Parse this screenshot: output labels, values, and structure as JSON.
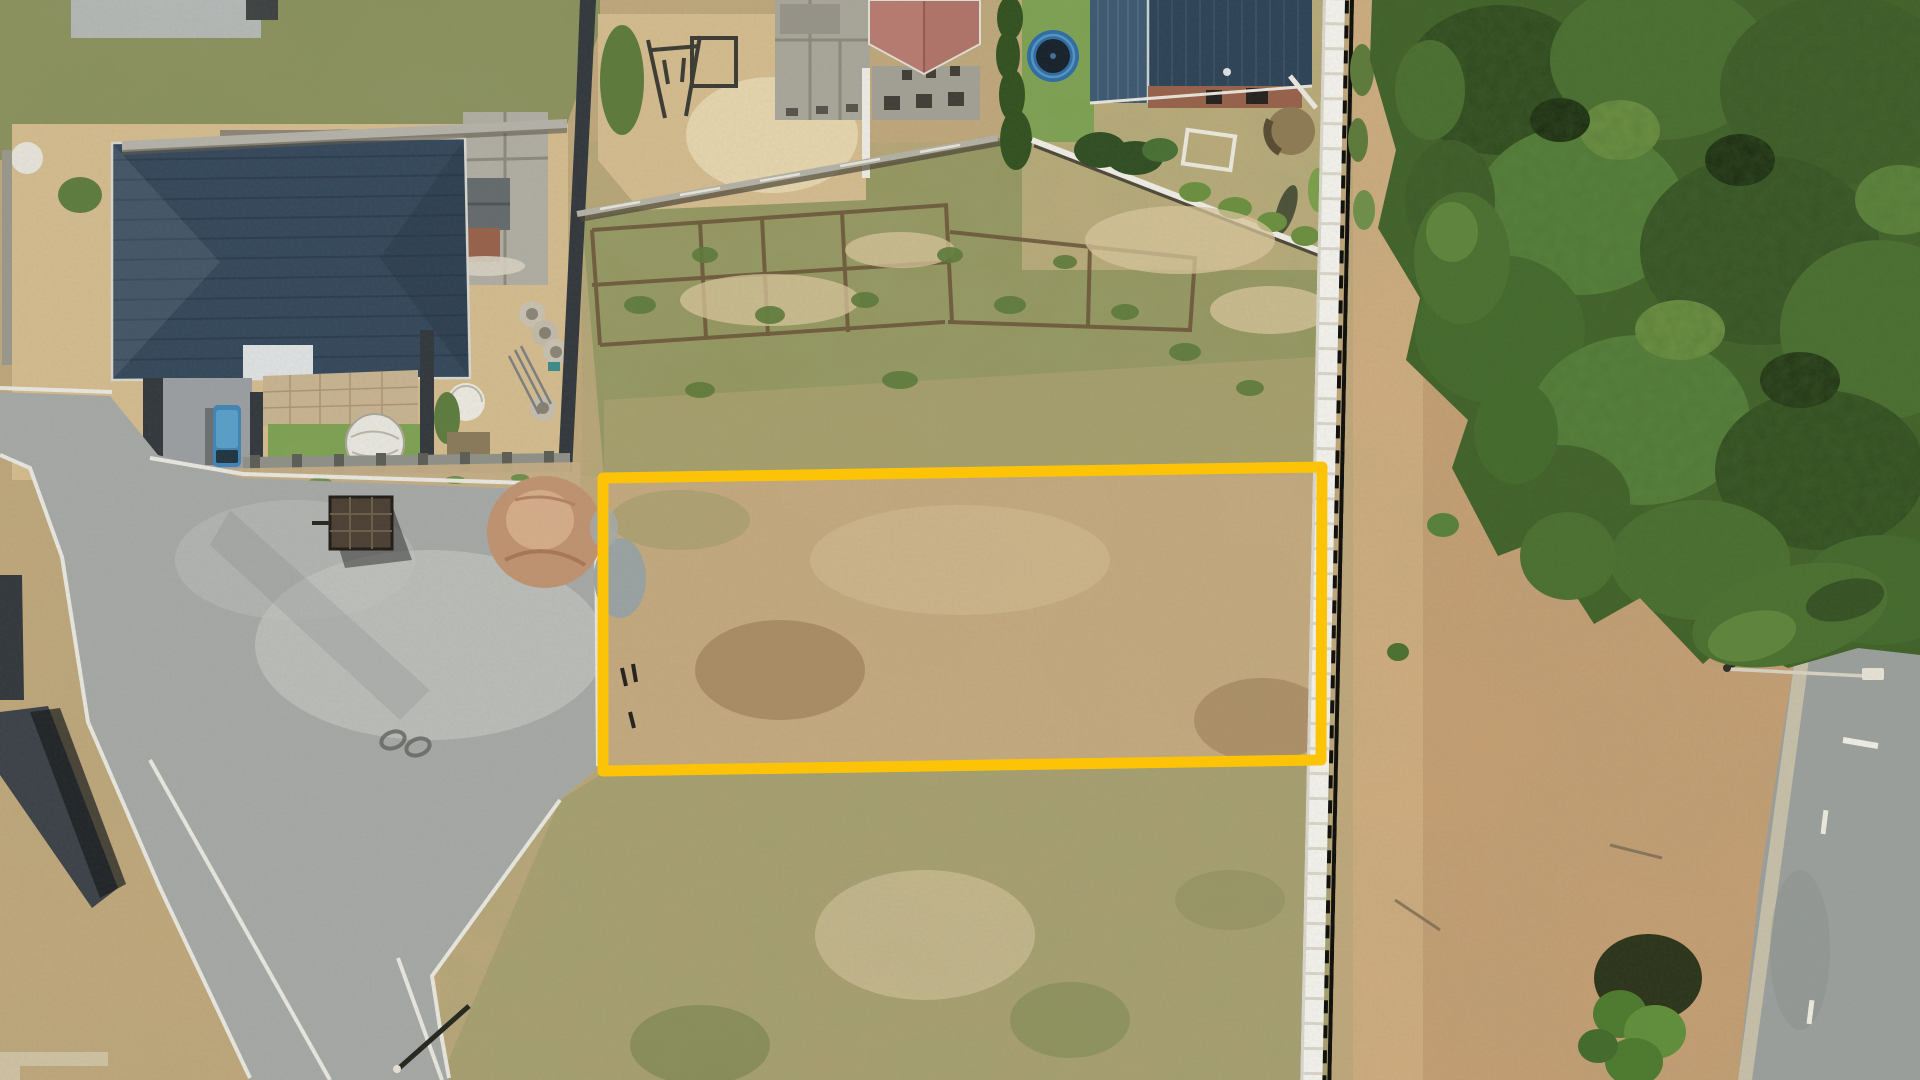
{
  "scene": {
    "type": "aerial-drone-photograph",
    "description": "Top-down aerial photo of a dry vacant residential plot outlined with a yellow boundary rectangle, flanked by houses and roads",
    "objects": [
      "highlight-plot-boundary",
      "vacant-plot",
      "old-foundation-trenches",
      "construction-yard-house-blue-roof",
      "house-under-construction-red-roof",
      "house-blue-roof-brick",
      "trampoline",
      "water-tank",
      "white-precast-boundary-wall",
      "tree-canopy",
      "left-road-junction",
      "right-road",
      "street-lights",
      "blue-van",
      "trailer",
      "sand-pile"
    ]
  },
  "highlight": {
    "shape": "rectangle",
    "color": "#fdc407",
    "stroke_width": 11,
    "corners_px": "603,478 1322,467 1321,760 603,771"
  },
  "colors": {
    "field_base": "#c3a97c",
    "upper_lot": "#93955c",
    "below_lot": "#b2a274",
    "dirt_right": "#c79f73",
    "asphalt": "#a6a9a7",
    "road_right": "#9aa09d",
    "navy_roof": "#33475c",
    "garage_gray": "#b0aea4",
    "blue_roof_left": "#3c5872",
    "blue_roof_right": "#2c4257",
    "red_roof": "#b0736a",
    "brick": "#97614b",
    "lawn": "#7aa24f",
    "hedge": "#31511f",
    "canopy_base": "#3f6128",
    "white_wall": "#f4f3ee",
    "sand": "#d4bc8f",
    "dirt_pile": "#c09372",
    "gravel": "#98a2a6",
    "van": "#3f85b8",
    "trampoline_ring": "#2d6da5",
    "trampoline_mat": "#15202b",
    "tank": "#8d7b53",
    "curb": "#e9e9e2",
    "dark_wall": "#31373d"
  }
}
